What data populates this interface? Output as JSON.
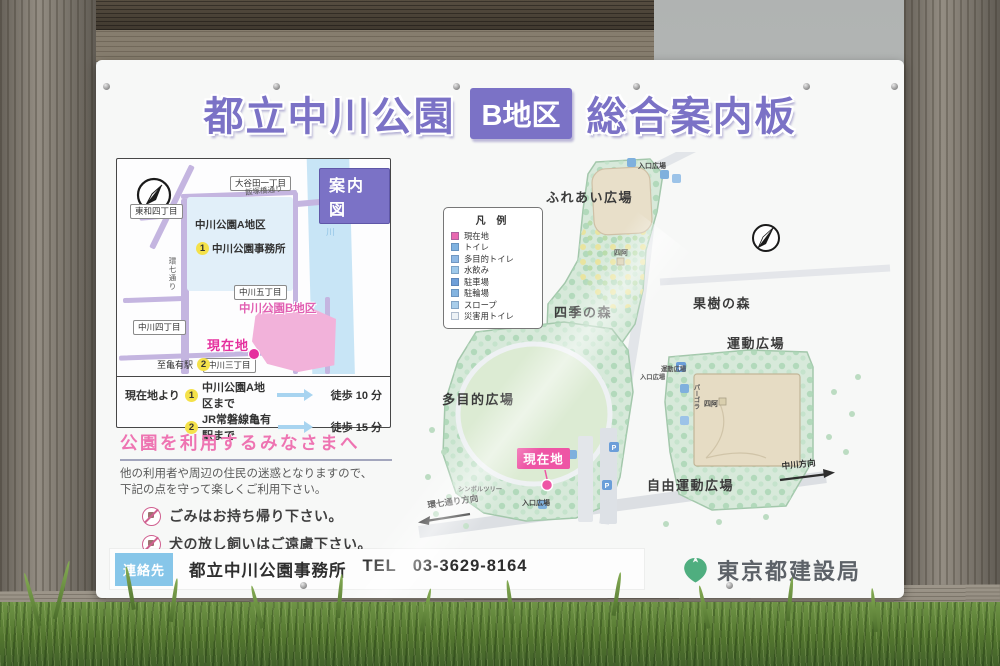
{
  "title": {
    "part1": "都立中川公園",
    "badge": "B地区",
    "part2": "総合案内板"
  },
  "inset_map": {
    "title": "案内図",
    "labels": {
      "otayata": "大谷田一丁目",
      "towa": "東和四丁目",
      "iizukabashi": "飯塚橋通り",
      "kanana": "環七通り",
      "area_a": "中川公園A地区",
      "office_no": "1",
      "office": "中川公園事務所",
      "nakagawa5": "中川五丁目",
      "nakagawa4": "中川四丁目",
      "nakagawa3": "中川三丁目",
      "area_b": "中川公園B地区",
      "current": "現在地",
      "kameari": "至亀有駅",
      "kameari_no": "2",
      "river": "中川"
    },
    "routes": [
      {
        "prefix": "現在地より",
        "no": "1",
        "dest": "中川公園A地区まで",
        "time": "徒歩 10 分"
      },
      {
        "prefix": "",
        "no": "2",
        "dest": "JR常磐線亀有駅まで",
        "time": "徒歩 15 分"
      }
    ]
  },
  "notice": {
    "title": "公園を利用するみなさまへ",
    "intro_line1": "他の利用者や周辺の住民の迷惑となりますので、",
    "intro_line2": "下記の点を守って楽しくご利用下さい。",
    "rules": [
      {
        "icon": "no-litter-icon",
        "text": "ごみはお持ち帰り下さい。"
      },
      {
        "icon": "no-unleashed-dog-icon",
        "text": "犬の放し飼いはご遠慮下さい。"
      },
      {
        "icon": "no-fire-icon",
        "text": "火気の使用は禁止します。"
      }
    ]
  },
  "park_map": {
    "legend": {
      "title": "凡 例",
      "items": [
        {
          "label": "現在地",
          "color": "#e868b0"
        },
        {
          "label": "トイレ",
          "color": "#7fb2e0"
        },
        {
          "label": "多目的トイレ",
          "color": "#8fb9e4"
        },
        {
          "label": "水飲み",
          "color": "#9fc9ea"
        },
        {
          "label": "駐車場",
          "color": "#6f9fd8"
        },
        {
          "label": "駐輪場",
          "color": "#84b4e0"
        },
        {
          "label": "スロープ",
          "color": "#a8cdea"
        },
        {
          "label": "災害用トイレ",
          "color": "#edf2f6"
        }
      ]
    },
    "labels": {
      "fureai": "ふれあい広場",
      "entrance_top": "入口広場",
      "shiki": "四季の森",
      "kaju": "果樹の森",
      "undo": "運動広場",
      "undo_small": "運動広場",
      "entrance_mid": "入口広場",
      "pergola": "パーゴラ",
      "azumaya1": "四阿",
      "azumaya2": "四阿",
      "tamokuteki": "多目的広場",
      "current": "現在地",
      "symbol_tree": "シンボルツリー",
      "jiyu": "自由運動広場",
      "entrance_bottom": "入口広場",
      "kanana_dir": "環七通り方向",
      "nakagawa_dir": "中川方向",
      "parking_letter": "P"
    }
  },
  "footer": {
    "contact_label": "連絡先",
    "office_name": "都立中川公園事務所",
    "tel_label": "TEL",
    "tel_number": "03-3629-8164",
    "agency": "東京都建設局"
  },
  "colors": {
    "accent_purple": "#7b72c6",
    "accent_pink": "#ee74b2",
    "current_magenta": "#e5309e",
    "river_blue": "#c8e5f6",
    "park_green": "#d7e9da",
    "plaza_tan": "#e8dfc9",
    "leaf_green": "#4fae7f",
    "contact_blue": "#87c6e9"
  }
}
